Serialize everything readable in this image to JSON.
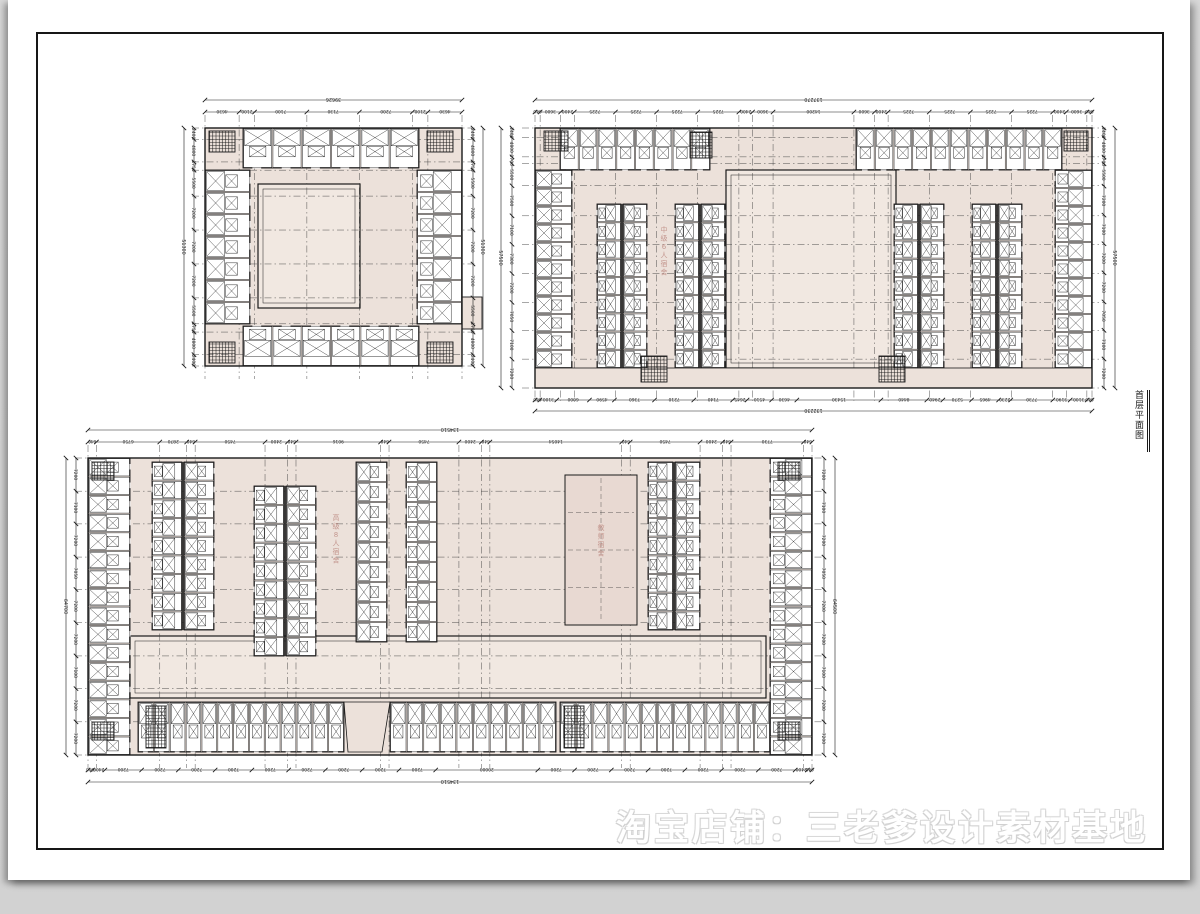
{
  "page": {
    "background": "#d5d5d5",
    "paper": "#ffffff",
    "frame_color": "#161616"
  },
  "palette": {
    "wall_fill_pink": "#ece1da",
    "court_pink": "#f1e8e1",
    "line_black": "#1a1a1a",
    "grid_gray": "#3c3c3c",
    "label_pink": "#c4978f",
    "dim_text": "#2e2e2e"
  },
  "title_block": {
    "text": "首层平面图"
  },
  "watermark": {
    "text": "淘宝店铺：三老爹设计素材基地"
  },
  "plans": [
    {
      "id": "plan-upper-left",
      "name": "courtyard dormitory block",
      "dim_top_total": "39626",
      "dim_top": [
        "4630",
        "2100",
        "7100",
        "7130",
        "7200",
        "2100",
        "4630"
      ],
      "dim_left": [
        "2400",
        "4800",
        "1750",
        "5500",
        "7200",
        "7200",
        "7200",
        "5500",
        "1750",
        "4800",
        "2400"
      ],
      "dim_left_total": "51300",
      "dim_right": [
        "2400",
        "4800",
        "1750",
        "5500",
        "7200",
        "7200",
        "7200",
        "5500",
        "1750",
        "4800",
        "2400"
      ],
      "dim_right_total": "51300",
      "labels": []
    },
    {
      "id": "plan-upper-right",
      "name": "triple courtyard dormitory block",
      "dim_top_total": "137270",
      "dim_top": [
        "640",
        "3600",
        "2400",
        "7225",
        "7225",
        "7225",
        "7225",
        "2400",
        "3600",
        "14200",
        "3600",
        "2400",
        "7225",
        "7225",
        "7225",
        "7225",
        "2400",
        "3600",
        "640"
      ],
      "dim_bottom": [
        "640",
        "3100",
        "6000",
        "4590",
        "7360",
        "7210",
        "7140",
        "2645",
        "4510",
        "4630",
        "15430",
        "8440",
        "2940",
        "5270",
        "4965",
        "2230",
        "7730",
        "3190",
        "3100",
        "640"
      ],
      "dim_bottom_total": "132230",
      "dim_left": [
        "2400",
        "4800",
        "1700",
        "5500",
        "7500",
        "7100",
        "7300",
        "7200",
        "7050",
        "7100",
        "7200"
      ],
      "dim_left_total": "57500",
      "dim_right": [
        "2400",
        "4800",
        "1700",
        "5500",
        "7200",
        "7100",
        "7200",
        "7200",
        "7050",
        "7100",
        "7200"
      ],
      "dim_right_total": "57500",
      "labels": [
        {
          "text": "中级6人宿舍"
        }
      ]
    },
    {
      "id": "plan-lower",
      "name": "large dormitory complex",
      "dim_top_total": "134510",
      "dim_top": [
        "640",
        "6750",
        "2870",
        "640",
        "7450",
        "2400",
        "640",
        "9016",
        "640",
        "7450",
        "2400",
        "640",
        "14054",
        "640",
        "7450",
        "2400",
        "640",
        "7730",
        "640"
      ],
      "dim_bottom": [
        "640",
        "2400",
        "7200",
        "7200",
        "7200",
        "7200",
        "7200",
        "7200",
        "7200",
        "7200",
        "7200",
        "20000",
        "7200",
        "7200",
        "7200",
        "7200",
        "7200",
        "7200",
        "7200",
        "2400",
        "640"
      ],
      "dim_bottom_total": "134510",
      "dim_left": [
        "7200",
        "7100",
        "7200",
        "7050",
        "7200",
        "7200",
        "7100",
        "7200",
        "7200"
      ],
      "dim_left_total": "64700",
      "dim_right": [
        "7200",
        "7100",
        "7200",
        "7050",
        "7200",
        "7200",
        "7100",
        "7200",
        "7200"
      ],
      "dim_right_total": "64500",
      "labels": [
        {
          "text": "高级8人宿舍"
        },
        {
          "text": "教师宿舍"
        }
      ]
    }
  ]
}
